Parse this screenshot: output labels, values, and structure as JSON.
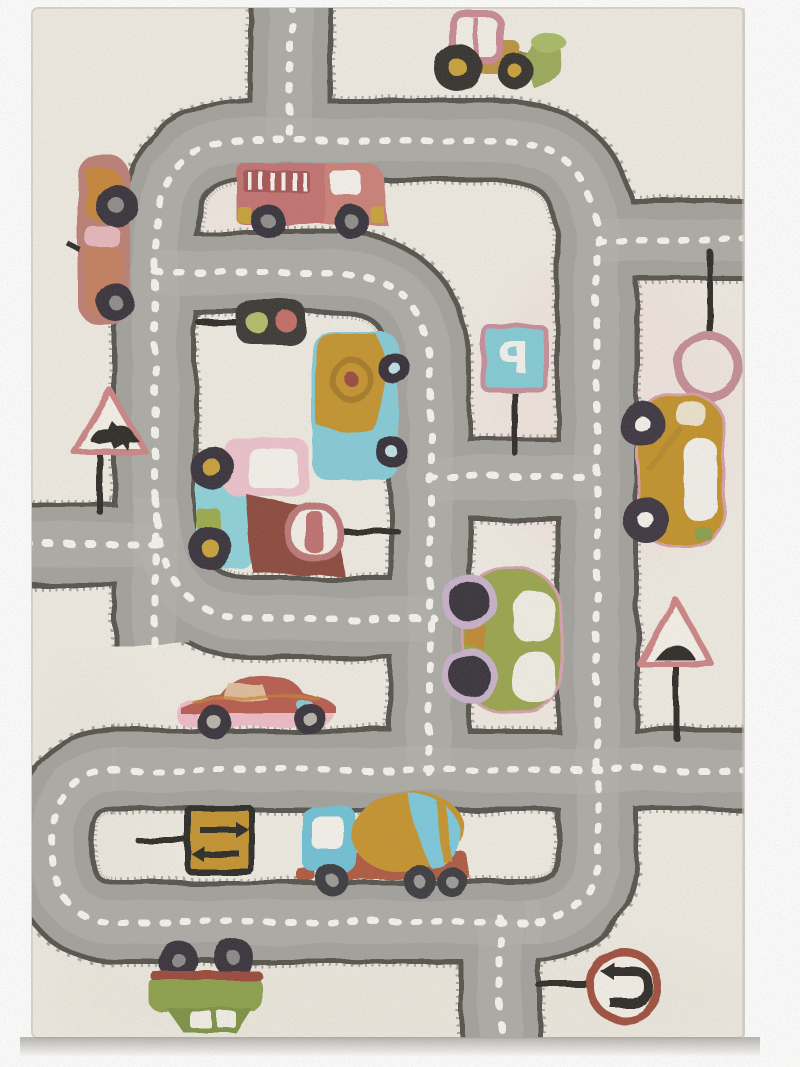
{
  "scene": {
    "type": "product photo",
    "subject": "children's road play rug with vehicles and traffic signs",
    "view": "top-down, portrait"
  },
  "palette": {
    "photo_background": "#ffffff",
    "rug_base": "#f0ece3",
    "rug_tint_pink": "#f0dcd8",
    "road_gray": "#a4a29d",
    "road_gray_light": "#b6b4af",
    "road_edge_dark": "#55524b",
    "road_dash_white": "#f7f5ef",
    "pole_black": "#2e2c27",
    "shadow_gray": "#b7b4ae"
  },
  "signs": {
    "parking": {
      "label": "P",
      "shape": "square",
      "fill": "#84ccd5",
      "border": "#c78f9c",
      "note": "letter appears mirrored on rug"
    },
    "warning_animal": {
      "symbol": "animal",
      "shape": "triangle",
      "border": "#cd8585"
    },
    "warning_bump": {
      "symbol": "speed-bump",
      "shape": "triangle",
      "border": "#cd8585"
    },
    "ring": {
      "symbol": "empty-ring",
      "shape": "circle",
      "border": "#c68d96"
    },
    "no_stopping": {
      "symbol": "vertical-bar",
      "shape": "circle",
      "border": "#bd7878"
    },
    "arrows": {
      "symbol": "opposing-arrows",
      "shape": "square",
      "fill": "#c5932d",
      "border": "#2b2925"
    },
    "u_turn": {
      "symbol": "u-turn-arrow",
      "shape": "circle",
      "border": "#a0503c"
    }
  },
  "traffic_light": {
    "housing": "#3b3834",
    "lights": [
      "#b4bd6a",
      "#c46d68"
    ]
  },
  "vehicles": [
    {
      "name": "front-loader-tractor",
      "location": "top edge of rug",
      "colors": [
        "#bb9440",
        "#c98a96",
        "#9cab5a"
      ]
    },
    {
      "name": "fire-truck",
      "location": "upper inner road",
      "colors": [
        "#c47272",
        "#a85555",
        "#f6f3ec"
      ]
    },
    {
      "name": "red-sports-car",
      "location": "left edge, driving down",
      "colors": [
        "#bd7f74",
        "#c8862e"
      ]
    },
    {
      "name": "camper-van",
      "location": "inner field",
      "colors": [
        "#c5942f",
        "#85ccd8"
      ]
    },
    {
      "name": "dump-truck",
      "location": "inner field",
      "colors": [
        "#eec3cd",
        "#8ed2da",
        "#8d4a3c"
      ]
    },
    {
      "name": "yellow-car",
      "location": "right side, driving down",
      "colors": [
        "#c3932b"
      ]
    },
    {
      "name": "green-beetle-car",
      "location": "middle pocket, driving down",
      "colors": [
        "#9aa64e",
        "#c9b2cc"
      ]
    },
    {
      "name": "pink-sports-car",
      "location": "above bottom loop, driving left",
      "colors": [
        "#b85c50",
        "#f0bcc8"
      ]
    },
    {
      "name": "cement-mixer-truck",
      "location": "bottom loop, driving left",
      "colors": [
        "#6fc2d6",
        "#c6942d",
        "#7cc9dc",
        "#b05a40"
      ]
    },
    {
      "name": "flipped-green-car",
      "location": "below bottom road, upside down",
      "colors": [
        "#8da14c",
        "#9a4a3a"
      ]
    }
  ],
  "road_markings": "white dashed center lines on all roads"
}
